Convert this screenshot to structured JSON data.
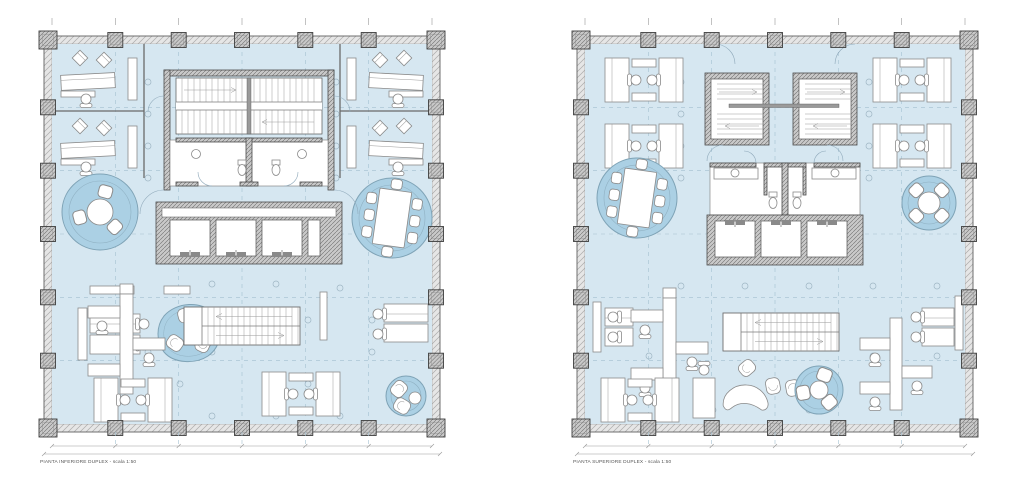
{
  "sheet": {
    "background": "#ffffff",
    "content_type": "architectural duplex office floor plans, two square plans side by side"
  },
  "plans": {
    "left": {
      "caption": "PIANTA INFERIORE DUPLEX - scala 1:50",
      "features": [
        "central core with double stair and WCs",
        "bank of 3 elevators",
        "2 cellular offices top-left",
        "2 cellular offices top-right",
        "round meeting circle with 3 seats",
        "conference circle with 8 seats",
        "open-plan desk clusters",
        "organic lounge island with armchairs",
        "straight internal duplex stair",
        "small lounge circle with 2 armchairs"
      ]
    },
    "right": {
      "caption": "PIANTA SUPERIORE DUPLEX - scala 1:50",
      "features": [
        "twin switch-back stair cores",
        "central WC block",
        "bank of 3 elevators",
        "conference circle with 8 seats",
        "round meeting circle with 4 seats",
        "paired desk workstations",
        "straight duplex stair landing",
        "lounge with curved sofa and round rug"
      ]
    }
  },
  "structure": {
    "columns_per_side": 7,
    "grid_bays": "6 x 6",
    "elevators_per_plan": 3,
    "dimension_ticks": "top and bottom dimension chains, unlabeled at this scale"
  },
  "colors": {
    "background": "#ffffff",
    "floor_fill": "#d6e7f1",
    "meeting_area_fill": "#abd0e4",
    "meeting_area_stroke": "#7fa3b6",
    "wall_hatch": "#e2e2e2",
    "column_fill": "#c9c9c9",
    "line_dark": "#4a4a4a",
    "furniture_stroke": "#8a8a8a",
    "grid_dash": "#a3c0d0",
    "dimension": "#9a9a9a",
    "caption_text": "#555555"
  }
}
